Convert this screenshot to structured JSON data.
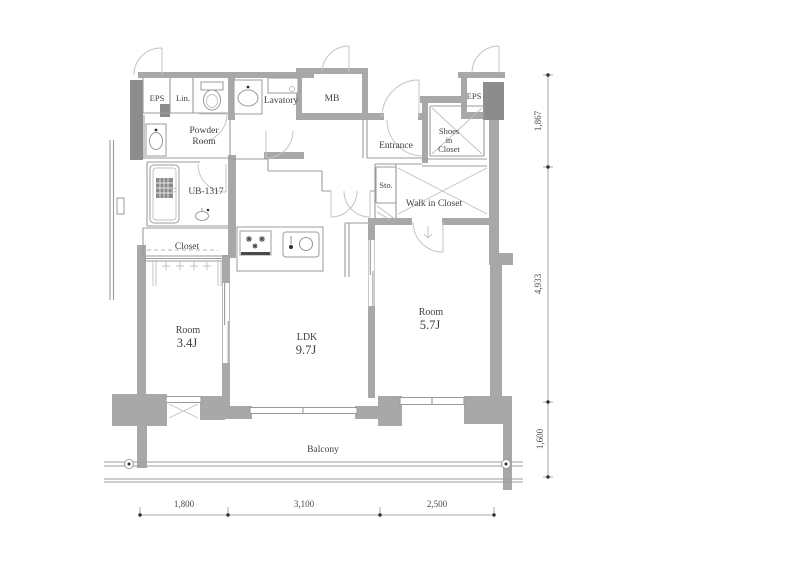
{
  "plan": {
    "labels": {
      "eps_left": "EPS",
      "lin": "Lin.",
      "lavatory": "Lavatory",
      "mb": "MB",
      "powder1": "Powder",
      "powder2": "Room",
      "entrance": "Entrance",
      "shoes1": "Shoes",
      "shoes2": "in",
      "shoes3": "Closet",
      "eps_right": "EPS",
      "ub": "UB-1317",
      "sto": "Sto.",
      "wic": "Walk in Closet",
      "closet": "Closet",
      "room1_name": "Room",
      "room1_size": "3.4J",
      "ldk_name": "LDK",
      "ldk_size": "9.7J",
      "room2_name": "Room",
      "room2_size": "5.7J",
      "balcony": "Balcony"
    },
    "dims": {
      "right": [
        "1,867",
        "4,933",
        "1,600"
      ],
      "bottom": [
        "1,800",
        "3,100",
        "2,500"
      ]
    },
    "colors": {
      "background": "#ffffff",
      "wall": "#a8a8a8",
      "column": "#8c8c8c",
      "partition_line": "#9b9b9b",
      "door_arc": "#c4c4c4",
      "text": "#3f3f3f",
      "dimension": "#8f8f8f"
    }
  }
}
